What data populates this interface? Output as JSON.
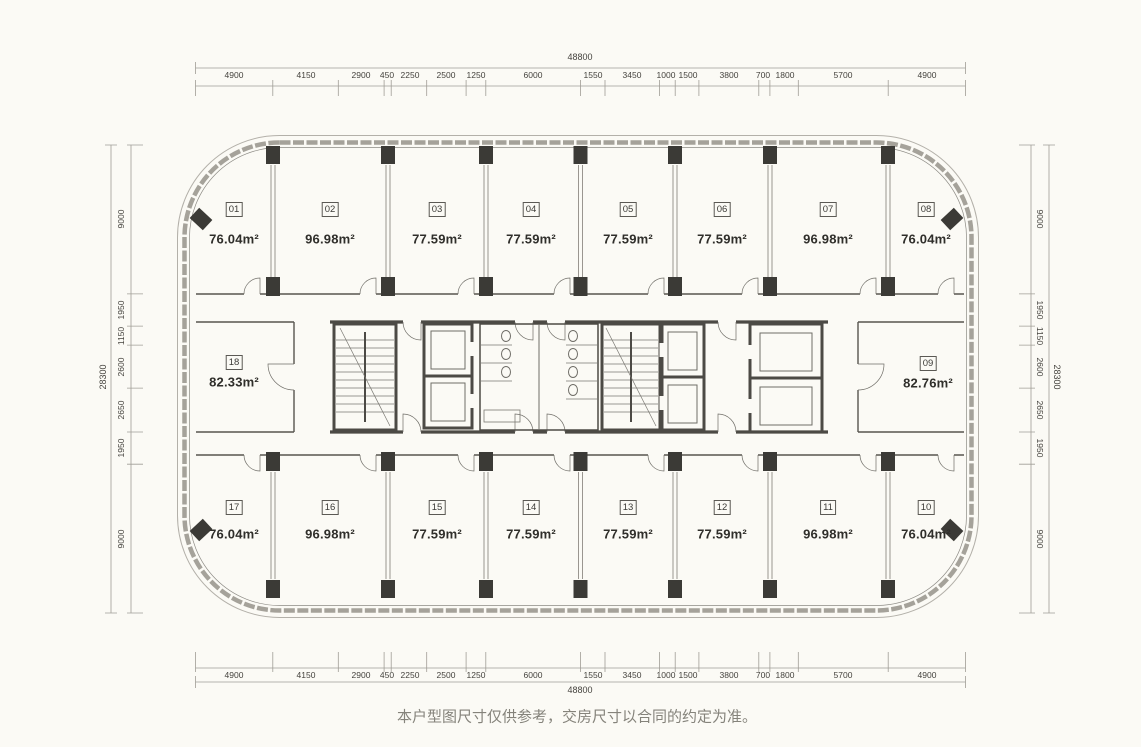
{
  "disclaimer": "本户型图尺寸仅供参考，交房尺寸以合同的约定为准。",
  "dimensions": {
    "top": {
      "total": "48800",
      "segments": [
        "4900",
        "4150",
        "2900",
        "450",
        "2250",
        "2500",
        "1250",
        "6000",
        "1550",
        "3450",
        "1000",
        "1500",
        "3800",
        "700",
        "1800",
        "5700",
        "4900"
      ]
    },
    "bottom": {
      "total": "48800",
      "segments": [
        "4900",
        "4150",
        "2900",
        "450",
        "2250",
        "2500",
        "1250",
        "6000",
        "1550",
        "3450",
        "1000",
        "1500",
        "3800",
        "700",
        "1800",
        "5700",
        "4900"
      ]
    },
    "left": {
      "total": "28300",
      "segments": [
        "9000",
        "1950",
        "1150",
        "2600",
        "2650",
        "1950",
        "9000"
      ]
    },
    "right": {
      "total": "28300",
      "segments": [
        "9000",
        "1950",
        "1150",
        "2600",
        "2650",
        "1950",
        "9000"
      ]
    }
  },
  "units": [
    {
      "id": "01",
      "area": "76.04m²"
    },
    {
      "id": "02",
      "area": "96.98m²"
    },
    {
      "id": "03",
      "area": "77.59m²"
    },
    {
      "id": "04",
      "area": "77.59m²"
    },
    {
      "id": "05",
      "area": "77.59m²"
    },
    {
      "id": "06",
      "area": "77.59m²"
    },
    {
      "id": "07",
      "area": "96.98m²"
    },
    {
      "id": "08",
      "area": "76.04m²"
    },
    {
      "id": "09",
      "area": "82.76m²"
    },
    {
      "id": "10",
      "area": "76.04m²"
    },
    {
      "id": "11",
      "area": "96.98m²"
    },
    {
      "id": "12",
      "area": "77.59m²"
    },
    {
      "id": "13",
      "area": "77.59m²"
    },
    {
      "id": "14",
      "area": "77.59m²"
    },
    {
      "id": "15",
      "area": "77.59m²"
    },
    {
      "id": "16",
      "area": "96.98m²"
    },
    {
      "id": "17",
      "area": "76.04m²"
    },
    {
      "id": "18",
      "area": "82.33m²"
    }
  ],
  "colors": {
    "background": "#fbfaf5",
    "wall": "#4c4a45",
    "column": "#3b3a36",
    "facade": "#a5a29a",
    "dimension_line": "#a09d96",
    "label_text": "#3b3a36",
    "area_text": "#2f2e2a",
    "disclaimer_text": "#85837b"
  }
}
